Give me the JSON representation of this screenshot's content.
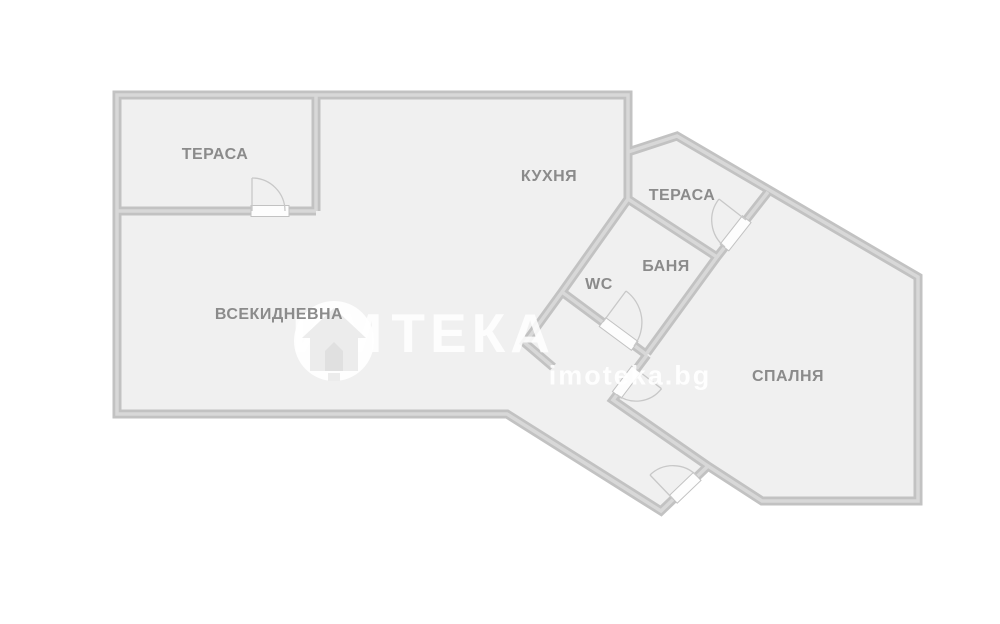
{
  "palette": {
    "background": "#ffffff",
    "room_fill": "#f0f0f0",
    "wall": "#c2c2c2",
    "wall_highlight": "#d8d8d8",
    "door_fill": "#fdfdfd",
    "door_border": "#c2c2c2",
    "arc": "#c8c8c8",
    "label_color": "#8b8b8b",
    "watermark_color": "rgba(255,255,255,0.85)"
  },
  "rooms": [
    {
      "id": "terrace-left",
      "label": "ТЕРАСА",
      "x": 215,
      "y": 155
    },
    {
      "id": "kitchen",
      "label": "КУХНЯ",
      "x": 549,
      "y": 177
    },
    {
      "id": "terrace-right",
      "label": "ТЕРАСА",
      "x": 682,
      "y": 196
    },
    {
      "id": "bathroom",
      "label": "БАНЯ",
      "x": 666,
      "y": 267
    },
    {
      "id": "wc",
      "label": "WC",
      "x": 599,
      "y": 285
    },
    {
      "id": "living-room",
      "label": "ВСЕКИДНЕВНА",
      "x": 279,
      "y": 315
    },
    {
      "id": "bedroom",
      "label": "СПАЛНЯ",
      "x": 788,
      "y": 377
    }
  ],
  "watermark": {
    "word_part1": "ИМ",
    "word_part2": "ТЕКА",
    "url": "imoteka.bg",
    "logo": "house-in-circle-icon"
  },
  "floorplan": {
    "wall_thickness": 9,
    "outline": [
      [
        117,
        95
      ],
      [
        628,
        95
      ],
      [
        628,
        152
      ],
      [
        677,
        136
      ],
      [
        918,
        277
      ],
      [
        918,
        501
      ],
      [
        762,
        501
      ],
      [
        708,
        466
      ],
      [
        661,
        511
      ],
      [
        507,
        414
      ],
      [
        117,
        414
      ]
    ],
    "inner_walls": [
      [
        [
          316,
          95
        ],
        [
          316,
          211
        ]
      ],
      [
        [
          117,
          211
        ],
        [
          316,
          211
        ]
      ],
      [
        [
          628,
          152
        ],
        [
          628,
          199
        ]
      ],
      [
        [
          628,
          199
        ],
        [
          717,
          257
        ]
      ],
      [
        [
          768,
          192
        ],
        [
          717,
          257
        ]
      ],
      [
        [
          628,
          199
        ],
        [
          562,
          292
        ]
      ],
      [
        [
          717,
          257
        ],
        [
          647,
          353
        ]
      ],
      [
        [
          562,
          292
        ],
        [
          647,
          355
        ]
      ],
      [
        [
          562,
          292
        ],
        [
          525,
          343
        ],
        [
          553,
          367
        ]
      ],
      [
        [
          647,
          355
        ],
        [
          613,
          400
        ],
        [
          708,
          466
        ]
      ]
    ],
    "doors": [
      {
        "id": "terrace-left-door",
        "cx": 270,
        "cy": 211,
        "len": 38,
        "angle": 0,
        "arc": "M 252 178 A 33 33 0 0 1 285 211",
        "leaf": "M 252 211 L 252 178"
      },
      {
        "id": "terrace-right-door",
        "cx": 735.6,
        "cy": 233.3,
        "len": 36,
        "angle": 128.1,
        "arc": "M 719 199 A 34 34 0 0 0 725 247",
        "leaf": "M 746 220 L 719 199"
      },
      {
        "id": "bathroom-door",
        "cx": 618.6,
        "cy": 334,
        "len": 40,
        "angle": 36.5,
        "arc": "M 626 291 A 39 39 0 0 1 634 346",
        "leaf": "M 603 322 L 626 291"
      },
      {
        "id": "hall-door",
        "cx": 626.5,
        "cy": 382.1,
        "len": 32,
        "angle": 127.1,
        "arc": "M 661.5 388.7 A 32 32 0 0 1 616.7 394.5",
        "leaf": "M 636 369 L 661.5 388.7"
      },
      {
        "id": "entrance-door",
        "cx": 685.3,
        "cy": 487.8,
        "len": 33,
        "angle": 136.2,
        "arc": "M 650 475 A 33 33 0 0 1 697 476",
        "leaf": "M 673 499 L 650 475"
      }
    ]
  }
}
